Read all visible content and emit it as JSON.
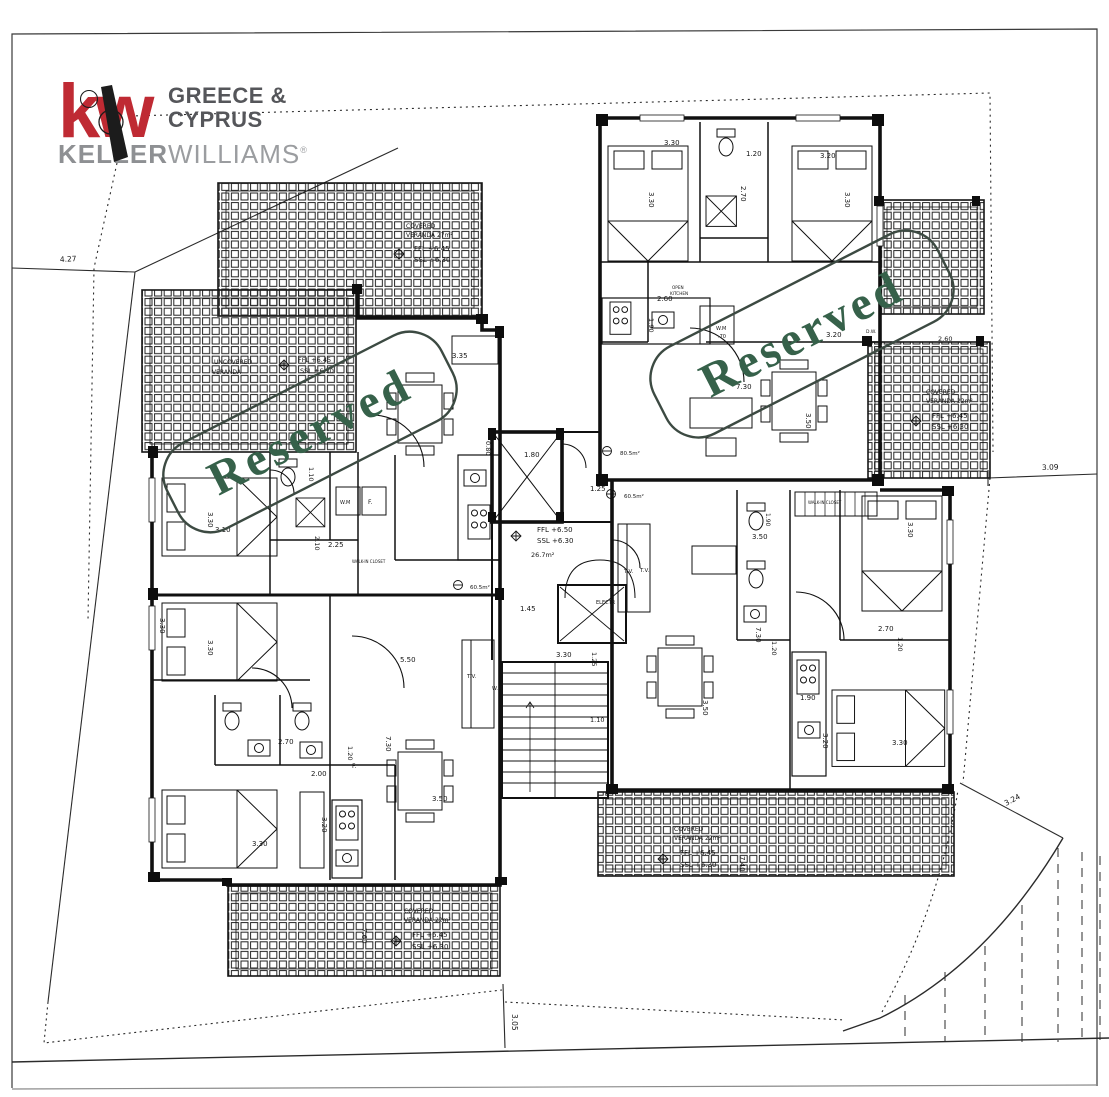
{
  "document_type": "architectural floor plan sheet",
  "logo": {
    "kw": "kw",
    "region_line1": "GREECE &",
    "region_line2": "CYPRUS",
    "brand_bold": "KELLER",
    "brand_light": "WILLIAMS",
    "reg_mark": "®",
    "brand_color": "#bf2a33",
    "gray_dark": "#55565a",
    "gray_mid": "#8e9093",
    "gray_light": "#9b9da0"
  },
  "stamps": [
    {
      "text": "Reserved",
      "cx": 310,
      "cy": 432,
      "rotation": -27,
      "w": 308,
      "h": 96,
      "color": "#36614a",
      "box_color": "#3c4a42"
    },
    {
      "text": "Reserved",
      "cx": 802,
      "cy": 334,
      "rotation": -27,
      "w": 318,
      "h": 98,
      "color": "#36614a",
      "box_color": "#3c4a42"
    }
  ],
  "plan": {
    "labels": [
      {
        "t": "4.27",
        "x": 60,
        "y": 262,
        "r": -3,
        "s": 7.5
      },
      {
        "t": "3.09",
        "x": 1042,
        "y": 470,
        "r": -2,
        "s": 7.5
      },
      {
        "t": "3.24",
        "x": 1006,
        "y": 806,
        "r": -28,
        "s": 7.5
      },
      {
        "t": "3.05",
        "x": 512,
        "y": 1014,
        "r": 90,
        "s": 7.5
      },
      {
        "t": "COVERED",
        "x": 406,
        "y": 228,
        "s": 6
      },
      {
        "t": "VERANDA 27m²",
        "x": 406,
        "y": 237,
        "s": 6
      },
      {
        "t": "FFL +6.45",
        "x": 414,
        "y": 251,
        "s": 7
      },
      {
        "t": "SSL +6.30",
        "x": 414,
        "y": 262,
        "s": 7
      },
      {
        "t": "UNCOVERED",
        "x": 214,
        "y": 364,
        "s": 6
      },
      {
        "t": "VERANDA",
        "x": 212,
        "y": 374,
        "s": 6
      },
      {
        "t": "FFL +6.45",
        "x": 298,
        "y": 362,
        "s": 6.5
      },
      {
        "t": "SSL +6.30",
        "x": 300,
        "y": 373,
        "s": 6.5
      },
      {
        "t": "COVERED",
        "x": 926,
        "y": 394,
        "s": 6
      },
      {
        "t": "VERANDA 22m²",
        "x": 926,
        "y": 403,
        "s": 6
      },
      {
        "t": "FFL +6.45",
        "x": 932,
        "y": 418,
        "s": 7
      },
      {
        "t": "SSL +6.30",
        "x": 932,
        "y": 429,
        "s": 7
      },
      {
        "t": "COVERED",
        "x": 404,
        "y": 913,
        "s": 6
      },
      {
        "t": "VERANDA 22m²",
        "x": 404,
        "y": 922,
        "s": 6
      },
      {
        "t": "FFL +6.45",
        "x": 412,
        "y": 937,
        "s": 7
      },
      {
        "t": "SSL +6.30",
        "x": 412,
        "y": 949,
        "s": 7
      },
      {
        "t": "7.60",
        "x": 362,
        "y": 928,
        "r": 90,
        "s": 7
      },
      {
        "t": "COVERED",
        "x": 674,
        "y": 831,
        "s": 6
      },
      {
        "t": "VERANDA 22m²",
        "x": 674,
        "y": 840,
        "s": 6
      },
      {
        "t": "FFL +6.45",
        "x": 680,
        "y": 855,
        "s": 7
      },
      {
        "t": "SSL +6.30",
        "x": 680,
        "y": 867,
        "s": 7
      },
      {
        "t": "7.40",
        "x": 740,
        "y": 856,
        "r": 90,
        "s": 7
      },
      {
        "t": "1.80",
        "x": 524,
        "y": 457,
        "s": 7
      },
      {
        "t": "1.25",
        "x": 590,
        "y": 491,
        "s": 7
      },
      {
        "t": "FFL +6.50",
        "x": 537,
        "y": 532,
        "s": 7
      },
      {
        "t": "SSL +6.30",
        "x": 537,
        "y": 543,
        "s": 7
      },
      {
        "t": "26.7m²",
        "x": 531,
        "y": 557,
        "s": 6.5
      },
      {
        "t": "80.5m²",
        "x": 620,
        "y": 455,
        "s": 5.5
      },
      {
        "t": "60.5m²",
        "x": 624,
        "y": 498,
        "s": 5.5
      },
      {
        "t": "60.5m²",
        "x": 470,
        "y": 589,
        "s": 5.5
      },
      {
        "t": "1.45",
        "x": 520,
        "y": 611,
        "s": 7
      },
      {
        "t": "ELECTR",
        "x": 596,
        "y": 604,
        "s": 5
      },
      {
        "t": "3.30",
        "x": 556,
        "y": 657,
        "s": 7
      },
      {
        "t": "1.25",
        "x": 592,
        "y": 652,
        "r": 90,
        "s": 6.5
      },
      {
        "t": "1.10",
        "x": 590,
        "y": 722,
        "s": 6.5
      },
      {
        "t": "T.V.",
        "x": 624,
        "y": 573,
        "s": 5.5
      },
      {
        "t": "3.30",
        "x": 649,
        "y": 192,
        "r": 90,
        "s": 7
      },
      {
        "t": "3.30",
        "x": 664,
        "y": 145,
        "s": 7
      },
      {
        "t": "1.20",
        "x": 746,
        "y": 156,
        "s": 7
      },
      {
        "t": "2.70",
        "x": 741,
        "y": 186,
        "r": 90,
        "s": 7
      },
      {
        "t": "3.20",
        "x": 820,
        "y": 158,
        "s": 7
      },
      {
        "t": "3.30",
        "x": 845,
        "y": 192,
        "r": 90,
        "s": 7
      },
      {
        "t": "2.60",
        "x": 657,
        "y": 301,
        "s": 7
      },
      {
        "t": "1.90",
        "x": 649,
        "y": 318,
        "r": 90,
        "s": 6.5
      },
      {
        "t": "W.M",
        "x": 716,
        "y": 330,
        "s": 5
      },
      {
        "t": ".70",
        "x": 718,
        "y": 338,
        "s": 5
      },
      {
        "t": "OPEN",
        "x": 672,
        "y": 289,
        "s": 4.2
      },
      {
        "t": "KITCHEN",
        "x": 670,
        "y": 295,
        "s": 4.2
      },
      {
        "t": "D.W.",
        "x": 866,
        "y": 333,
        "s": 4.5
      },
      {
        "t": "3.20",
        "x": 826,
        "y": 337,
        "s": 7
      },
      {
        "t": "7.30",
        "x": 736,
        "y": 389,
        "s": 7
      },
      {
        "t": "3.50",
        "x": 806,
        "y": 413,
        "r": 90,
        "s": 7
      },
      {
        "t": "2.60",
        "x": 938,
        "y": 341,
        "s": 6.5
      },
      {
        "t": "3.50",
        "x": 752,
        "y": 539,
        "s": 7
      },
      {
        "t": "T.V.",
        "x": 640,
        "y": 572,
        "s": 5.5
      },
      {
        "t": "7.30",
        "x": 756,
        "y": 627,
        "r": 90,
        "s": 7
      },
      {
        "t": "1.20",
        "x": 772,
        "y": 641,
        "r": 90,
        "s": 6.5
      },
      {
        "t": "3.50",
        "x": 703,
        "y": 700,
        "r": 90,
        "s": 7
      },
      {
        "t": "1.90",
        "x": 800,
        "y": 700,
        "s": 7
      },
      {
        "t": "3.20",
        "x": 823,
        "y": 733,
        "r": 90,
        "s": 7
      },
      {
        "t": "3.30",
        "x": 892,
        "y": 745,
        "s": 7
      },
      {
        "t": "2.70",
        "x": 878,
        "y": 631,
        "s": 7
      },
      {
        "t": "1.20",
        "x": 898,
        "y": 637,
        "r": 90,
        "s": 6.5
      },
      {
        "t": "3.30",
        "x": 908,
        "y": 522,
        "r": 90,
        "s": 7
      },
      {
        "t": "WALK-IN CLOSET",
        "x": 808,
        "y": 504,
        "s": 4
      },
      {
        "t": "1.90",
        "x": 766,
        "y": 513,
        "r": 90,
        "s": 6
      },
      {
        "t": "3.35",
        "x": 452,
        "y": 358,
        "s": 7
      },
      {
        "t": "1.10",
        "x": 309,
        "y": 467,
        "r": 90,
        "s": 6.5
      },
      {
        "t": "3.30",
        "x": 208,
        "y": 512,
        "r": 90,
        "s": 7
      },
      {
        "t": "3.10",
        "x": 215,
        "y": 532,
        "s": 7
      },
      {
        "t": "2.10",
        "x": 315,
        "y": 536,
        "r": 90,
        "s": 6.5
      },
      {
        "t": "2.25",
        "x": 328,
        "y": 547,
        "s": 7
      },
      {
        "t": "W.M",
        "x": 340,
        "y": 504,
        "s": 5
      },
      {
        "t": "F.",
        "x": 368,
        "y": 504,
        "s": 6
      },
      {
        "t": "0.80",
        "x": 486,
        "y": 441,
        "r": 90,
        "s": 6.5
      },
      {
        "t": "WALK-IN CLOSET",
        "x": 352,
        "y": 563,
        "s": 4
      },
      {
        "t": "3.30",
        "x": 160,
        "y": 618,
        "r": 90,
        "s": 7
      },
      {
        "t": "3.30",
        "x": 208,
        "y": 640,
        "r": 90,
        "s": 7
      },
      {
        "t": "5.50",
        "x": 400,
        "y": 662,
        "s": 7
      },
      {
        "t": "W.M",
        "x": 492,
        "y": 690,
        "s": 5
      },
      {
        "t": "T.V.",
        "x": 467,
        "y": 678,
        "s": 5.5
      },
      {
        "t": "7.30",
        "x": 386,
        "y": 736,
        "r": 90,
        "s": 7
      },
      {
        "t": "1.20",
        "x": 348,
        "y": 746,
        "r": 90,
        "s": 6.5
      },
      {
        "t": "2.70",
        "x": 278,
        "y": 744,
        "s": 7
      },
      {
        "t": "2.00",
        "x": 311,
        "y": 776,
        "s": 7
      },
      {
        "t": "F.",
        "x": 352,
        "y": 768,
        "s": 6
      },
      {
        "t": "3.50",
        "x": 432,
        "y": 801,
        "s": 7
      },
      {
        "t": "3.20",
        "x": 322,
        "y": 817,
        "r": 90,
        "s": 7
      },
      {
        "t": "3.30",
        "x": 252,
        "y": 846,
        "s": 7
      }
    ]
  }
}
